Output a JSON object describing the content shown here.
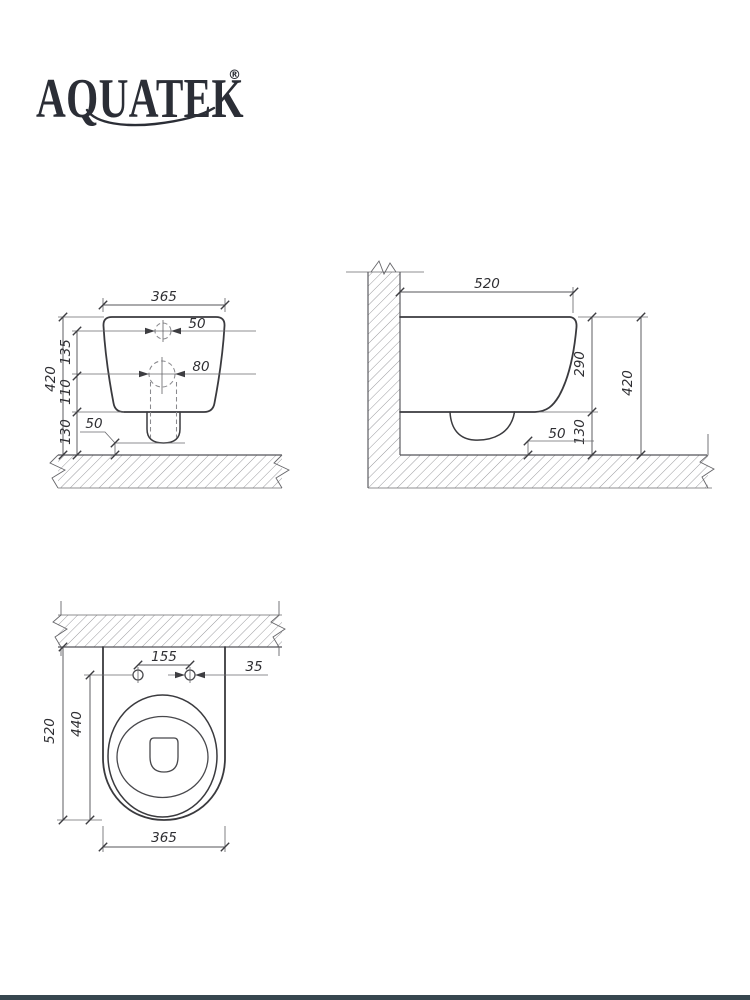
{
  "brand": {
    "name": "AQUATEK",
    "registered_mark": "®"
  },
  "colors": {
    "line": "#3a3a3e",
    "logo": "#2b2e36",
    "footer_bar": "#37474f"
  },
  "drawing": {
    "front_view": {
      "width_mm": "365",
      "inlet_hole_dia": "50",
      "outlet_hole_dia": "80",
      "inlet_to_outlet": "135",
      "outlet_to_bottom": "110",
      "bottom_to_floor": "130",
      "total_height": "420",
      "outlet_floor_gap": "50"
    },
    "side_view": {
      "depth": "520",
      "body_height": "290",
      "bottom_to_floor": "130",
      "total_height": "420",
      "outlet_floor_gap": "50"
    },
    "top_view": {
      "seat_hole_spacing": "155",
      "seat_hole_dia": "35",
      "depth": "520",
      "holes_to_front": "440",
      "width": "365"
    }
  }
}
